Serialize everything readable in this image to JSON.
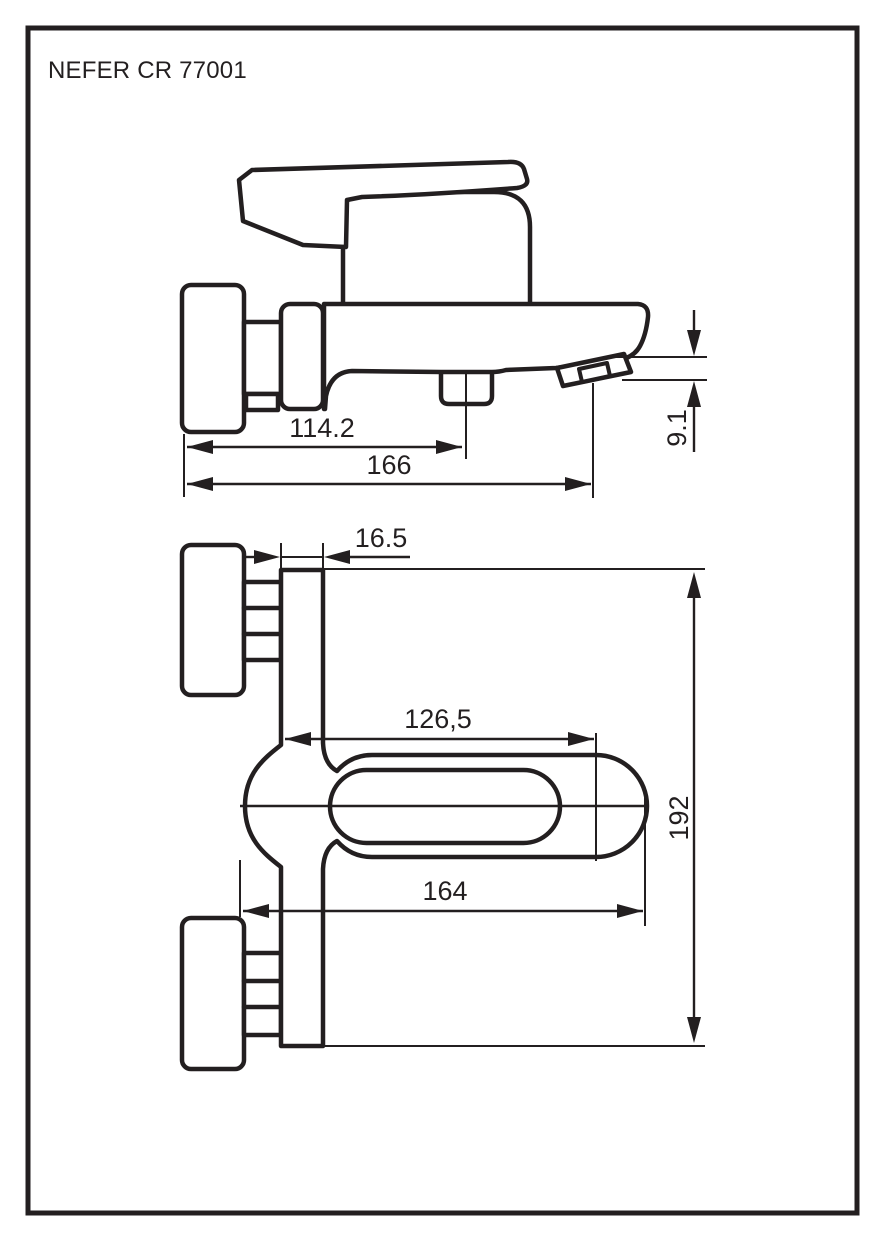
{
  "title": "NEFER CR 77001",
  "ink_color": "#231f20",
  "drawing": {
    "type": "technical-dimension-drawing",
    "views": [
      "side-view",
      "top-view"
    ]
  },
  "dimensions": {
    "side": {
      "wall_to_diverter": "114.2",
      "overall_length": "166",
      "spout_drop": "9.1"
    },
    "top": {
      "body_width": "16.5",
      "wall_to_handle": "126,5",
      "handle_length": "164",
      "overall_depth": "192"
    }
  }
}
